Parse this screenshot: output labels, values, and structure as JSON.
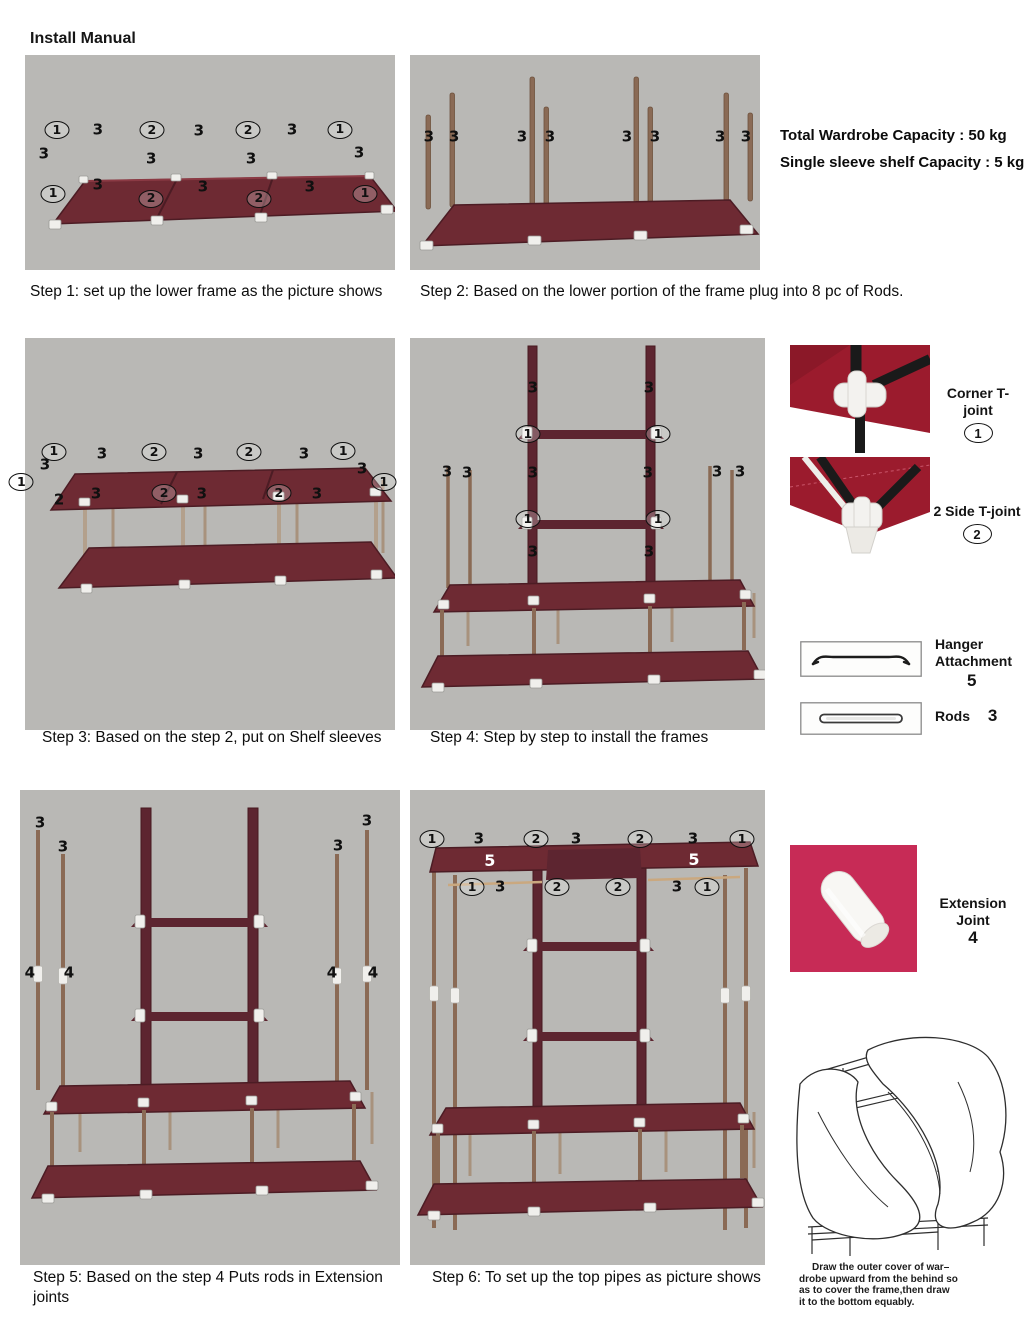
{
  "page": {
    "title": "Install Manual"
  },
  "colors": {
    "photo_bg": "#b9b8b5",
    "shelf": "#6e2a33",
    "shelf_dark": "#4c1c24",
    "ladder": "#5d2530",
    "pole": "#8a6a55",
    "pole_light": "#a8927d",
    "joint": "#f0efec",
    "accent_pink": "#c72b56",
    "fabric_red": "#9b1b2d",
    "ink": "#111111"
  },
  "capacity": {
    "line1": "Total Wardrobe Capacity : 50 kg",
    "line2": "Single sleeve shelf Capacity : 5 kg"
  },
  "steps": [
    {
      "caption": "Step 1:  set up the lower frame as the picture shows",
      "labels": [
        {
          "t": "1",
          "x": 8.6,
          "y": 35,
          "c": true
        },
        {
          "t": "3",
          "x": 19.7,
          "y": 35
        },
        {
          "t": "2",
          "x": 34.3,
          "y": 35,
          "c": true
        },
        {
          "t": "3",
          "x": 47,
          "y": 35.5
        },
        {
          "t": "2",
          "x": 60.3,
          "y": 35,
          "c": true
        },
        {
          "t": "3",
          "x": 72.2,
          "y": 34.7
        },
        {
          "t": "1",
          "x": 85.1,
          "y": 34.7,
          "c": true
        },
        {
          "t": "3",
          "x": 5.1,
          "y": 46
        },
        {
          "t": "3",
          "x": 34.1,
          "y": 48.5
        },
        {
          "t": "3",
          "x": 61.1,
          "y": 48.5
        },
        {
          "t": "3",
          "x": 90.3,
          "y": 45.5
        },
        {
          "t": "1",
          "x": 7.6,
          "y": 64.5,
          "c": true
        },
        {
          "t": "3",
          "x": 19.7,
          "y": 60.5
        },
        {
          "t": "2",
          "x": 34.1,
          "y": 66.8,
          "c": true
        },
        {
          "t": "3",
          "x": 48.1,
          "y": 61.5
        },
        {
          "t": "2",
          "x": 63.2,
          "y": 66.8,
          "c": true
        },
        {
          "t": "3",
          "x": 77,
          "y": 61.5
        },
        {
          "t": "1",
          "x": 91.9,
          "y": 64.5,
          "c": true
        }
      ]
    },
    {
      "caption": "Step 2: Based on the lower portion of the frame plug into 8 pc of Rods.",
      "labels": [
        {
          "t": "3",
          "x": 5.4,
          "y": 38
        },
        {
          "t": "3",
          "x": 12.6,
          "y": 38
        },
        {
          "t": "3",
          "x": 32,
          "y": 38
        },
        {
          "t": "3",
          "x": 40,
          "y": 38
        },
        {
          "t": "3",
          "x": 62,
          "y": 38
        },
        {
          "t": "3",
          "x": 70,
          "y": 38
        },
        {
          "t": "3",
          "x": 88.6,
          "y": 38
        },
        {
          "t": "3",
          "x": 96,
          "y": 38
        }
      ]
    },
    {
      "caption": "Step 3: Based on the step 2, put on Shelf sleeves",
      "labels": [
        {
          "t": "1",
          "x": 7.8,
          "y": 29,
          "c": true
        },
        {
          "t": "3",
          "x": 20.8,
          "y": 29.5
        },
        {
          "t": "2",
          "x": 34.9,
          "y": 29.2,
          "c": true
        },
        {
          "t": "3",
          "x": 46.8,
          "y": 29.5
        },
        {
          "t": "2",
          "x": 60.5,
          "y": 29.2,
          "c": true
        },
        {
          "t": "3",
          "x": 75.4,
          "y": 29.5
        },
        {
          "t": "1",
          "x": 86,
          "y": 28.8,
          "c": true
        },
        {
          "t": "3",
          "x": 5.4,
          "y": 32.5
        },
        {
          "t": "1",
          "x": -1,
          "y": 36.8,
          "c": true
        },
        {
          "t": "3",
          "x": 91.1,
          "y": 33.5
        },
        {
          "t": "1",
          "x": 97,
          "y": 36.8,
          "c": true
        },
        {
          "t": "2",
          "x": 9.2,
          "y": 41.3
        },
        {
          "t": "3",
          "x": 19.2,
          "y": 39.9
        },
        {
          "t": "2",
          "x": 37.6,
          "y": 39.5,
          "c": true
        },
        {
          "t": "3",
          "x": 47.8,
          "y": 39.9
        },
        {
          "t": "2",
          "x": 68.6,
          "y": 39.5,
          "c": true
        },
        {
          "t": "3",
          "x": 78.9,
          "y": 39.9
        }
      ]
    },
    {
      "caption": "Step 4: Step by step to install the frames",
      "labels": [
        {
          "t": "3",
          "x": 34.6,
          "y": 12.7
        },
        {
          "t": "3",
          "x": 67.3,
          "y": 12.7
        },
        {
          "t": "1",
          "x": 33.2,
          "y": 24.6,
          "c": true
        },
        {
          "t": "1",
          "x": 69.9,
          "y": 24.6,
          "c": true
        },
        {
          "t": "3",
          "x": 10.4,
          "y": 34.2
        },
        {
          "t": "3",
          "x": 16.1,
          "y": 34.4
        },
        {
          "t": "3",
          "x": 34.6,
          "y": 34.4
        },
        {
          "t": "3",
          "x": 67,
          "y": 34.4
        },
        {
          "t": "3",
          "x": 86.5,
          "y": 34.2
        },
        {
          "t": "3",
          "x": 93,
          "y": 34.2
        },
        {
          "t": "1",
          "x": 33.2,
          "y": 46.3,
          "c": true
        },
        {
          "t": "1",
          "x": 69.9,
          "y": 46.3,
          "c": true
        },
        {
          "t": "3",
          "x": 34.6,
          "y": 54.7
        },
        {
          "t": "3",
          "x": 67.3,
          "y": 54.7
        }
      ]
    },
    {
      "caption": "Step 5: Based on the step 4 Puts rods in Extension joints",
      "labels": [
        {
          "t": "3",
          "x": 5.3,
          "y": 6.9
        },
        {
          "t": "3",
          "x": 11.3,
          "y": 12
        },
        {
          "t": "3",
          "x": 83.7,
          "y": 11.8
        },
        {
          "t": "3",
          "x": 91.3,
          "y": 6.5
        },
        {
          "t": "4",
          "x": 2.6,
          "y": 38.5
        },
        {
          "t": "4",
          "x": 12.9,
          "y": 38.5
        },
        {
          "t": "4",
          "x": 82.1,
          "y": 38.5
        },
        {
          "t": "4",
          "x": 92.9,
          "y": 38.5
        }
      ]
    },
    {
      "caption": "Step 6: To set up the top pipes as picture shows",
      "labels": [
        {
          "t": "1",
          "x": 6.2,
          "y": 10.3,
          "c": true
        },
        {
          "t": "3",
          "x": 19.4,
          "y": 10.3
        },
        {
          "t": "2",
          "x": 35.5,
          "y": 10.3,
          "c": true
        },
        {
          "t": "3",
          "x": 46.8,
          "y": 10.3
        },
        {
          "t": "2",
          "x": 64.8,
          "y": 10.3,
          "c": true
        },
        {
          "t": "3",
          "x": 79.7,
          "y": 10.3
        },
        {
          "t": "1",
          "x": 93.5,
          "y": 10.3,
          "c": true
        },
        {
          "t": "5",
          "x": 22.5,
          "y": 14.9,
          "w": true
        },
        {
          "t": "5",
          "x": 80,
          "y": 14.7,
          "w": true
        },
        {
          "t": "1",
          "x": 17.5,
          "y": 20.4,
          "c": true
        },
        {
          "t": "3",
          "x": 25.4,
          "y": 20.4
        },
        {
          "t": "2",
          "x": 41.4,
          "y": 20.4,
          "c": true
        },
        {
          "t": "2",
          "x": 58.6,
          "y": 20.4,
          "c": true
        },
        {
          "t": "3",
          "x": 75.2,
          "y": 20.4
        },
        {
          "t": "1",
          "x": 83.7,
          "y": 20.4,
          "c": true
        }
      ]
    }
  ],
  "parts": {
    "corner": {
      "label": "Corner T-joint",
      "count": "1"
    },
    "side": {
      "label": "2 Side T-joint",
      "count": "2"
    },
    "hanger": {
      "line1": "Hanger",
      "line2": "Attachment",
      "count": "5"
    },
    "rods": {
      "label": "Rods",
      "count": "3"
    },
    "extension": {
      "label": "Extension Joint",
      "count": "4"
    }
  },
  "cover_note": {
    "l1": "Draw the outer cover of war–",
    "l2": "drobe upward from the behind so",
    "l3": "as to cover the frame,then draw",
    "l4": "it to the bottom equably."
  }
}
